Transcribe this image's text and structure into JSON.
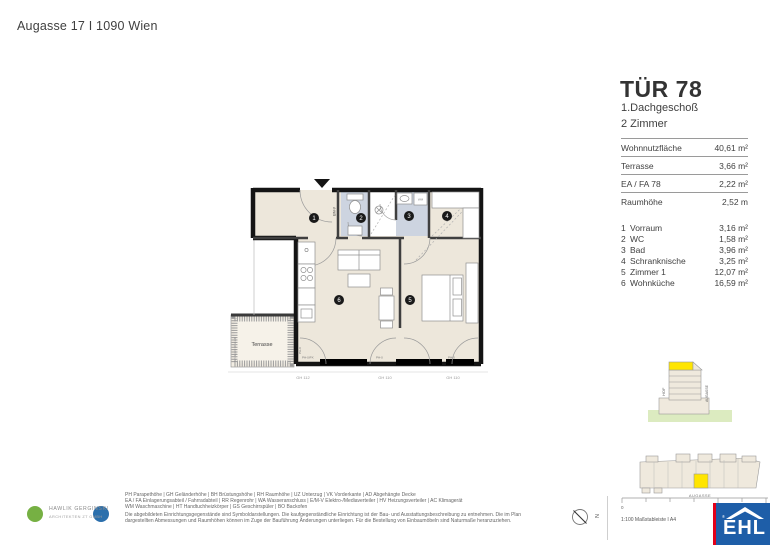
{
  "header": {
    "address": "Augasse 17 I 1090 Wien"
  },
  "unit": {
    "title": "TÜR 78",
    "floor": "1.Dachgeschoß",
    "rooms": "2 Zimmer"
  },
  "summary": {
    "rows": [
      {
        "label": "Wohnnutzfläche",
        "value": "40,61 m²"
      },
      {
        "label": "Terrasse",
        "value": "3,66 m²"
      },
      {
        "label": "EA / FA 78",
        "value": "2,22 m²"
      },
      {
        "label": "Raumhöhe",
        "value": "2,52 m"
      }
    ]
  },
  "room_list": [
    {
      "no": "1",
      "name": "Vorraum",
      "area": "3,16 m²"
    },
    {
      "no": "2",
      "name": "WC",
      "area": "1,58 m²"
    },
    {
      "no": "3",
      "name": "Bad",
      "area": "3,96 m²"
    },
    {
      "no": "4",
      "name": "Schranknische",
      "area": "3,25 m²"
    },
    {
      "no": "5",
      "name": "Zimmer 1",
      "area": "12,07 m²"
    },
    {
      "no": "6",
      "name": "Wohnküche",
      "area": "16,59 m²"
    }
  ],
  "plan": {
    "terrace_label": "Terrasse",
    "terrace_side_label": "Schrägschnitt H 230",
    "entrance_wall_label": "E/M-V",
    "wm_label": "WM",
    "window_labels": [
      "PH-0/PX",
      "PH-0",
      "PH-0"
    ],
    "window_side_label": "PH-0",
    "dimension_labels": [
      "GH 112",
      "GH 110",
      "GH 110"
    ]
  },
  "diagrams": {
    "section": {
      "left_label": "HOF",
      "right_label": "AUGASSE"
    },
    "site": {
      "street_label": "AUGASSE"
    }
  },
  "footer": {
    "legend_lines": [
      "PH Parapethöhe | GH Geländerhöhe | BH Brüstungshöhe  |  RH Raumhöhe | UZ Unterzug | VK Vorderkante | AD Abgehängte Decke",
      "EA / FA Einlagerungsabteil / Fahrradabteil | RR Regenrohr | WA Wasseranschluss | E/M-V Elektro-/Mediaverteiler | HV Heizungsverteiler | AC Klimagerät",
      "WM Waschmaschine | HT Handtuchheizkörper | GS Geschirrspüler | BO Backofen"
    ],
    "disclaimer_lines": [
      "Die abgebildeten Einrichtungsgegenstände sind Symboldarstellungen. Die kaufgegenständliche Einrichtung ist der Bau- und Ausstattungsbeschreibung zu entnehmen. Die im Plan",
      "dargestellten Abmessungen und Raumhöhen können im Zuge der Bauführung Änderungen unterliegen. Für die Bestellung von Einbaumöbeln sind Naturmaße heranzuziehen."
    ],
    "architects": {
      "name": "HAWLIK GERGINSKI",
      "subtitle": "ARCHITEKTEN ZT GMBH"
    },
    "north_label": "N",
    "scale_zero": "0",
    "scale_text": "1:100 Maßstableiste I A4",
    "ehl_logo_text": "EHL"
  },
  "colors": {
    "accent_yellow": "#FFE500",
    "wet_room_blue": "#CDD4E0",
    "floor_beige": "#EDE7DB",
    "ground_green": "#DCEBC0",
    "ehl_blue": "#1E5EA8",
    "ehl_red": "#E2001A",
    "logo_green": "#76B043",
    "logo_blue": "#2B6FAC"
  }
}
